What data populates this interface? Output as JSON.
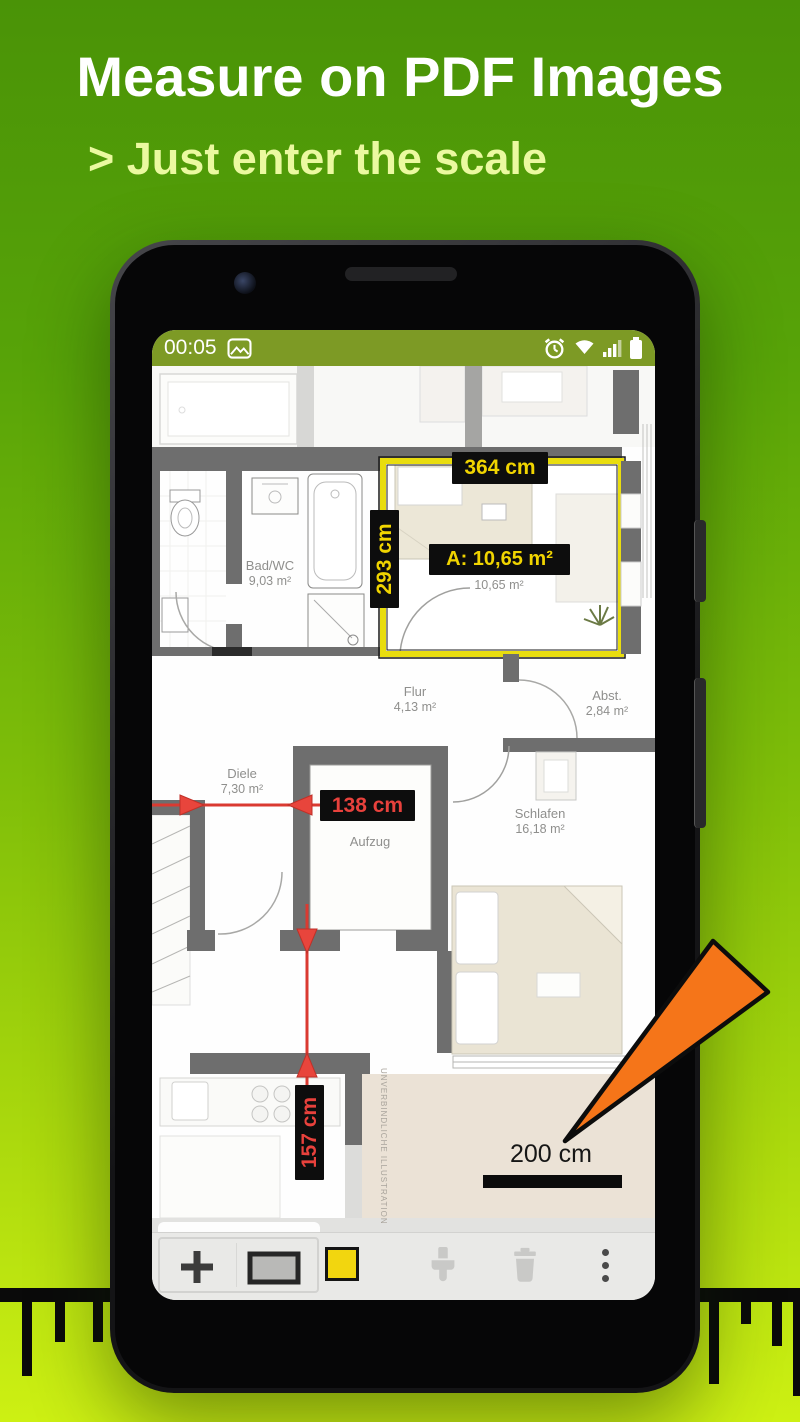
{
  "header": {
    "title": "Measure on PDF Images",
    "subtitle": "> Just enter the scale"
  },
  "statusbar": {
    "time": "00:05"
  },
  "measurements": {
    "width_label": "364 cm",
    "height_label": "293 cm",
    "area_label": "A: 10,65 m²",
    "corridor_label": "138 cm",
    "kitchen_label": "157 cm"
  },
  "floorplan": {
    "rooms": {
      "badwc": {
        "name": "Bad/WC",
        "area": "9,03 m²"
      },
      "zimmer": {
        "name": "Zimmer",
        "area": "10,65 m²"
      },
      "flur": {
        "name": "Flur",
        "area": "4,13 m²"
      },
      "abst": {
        "name": "Abst.",
        "area": "2,84 m²"
      },
      "diele": {
        "name": "Diele",
        "area": "7,30 m²"
      },
      "aufzug": {
        "name": "Aufzug"
      },
      "schlafen": {
        "name": "Schlafen",
        "area": "16,18 m²"
      }
    },
    "scale_label": "200 cm",
    "watermark": "UNVERBINDLICHE ILLUSTRATION"
  },
  "colors": {
    "bg_top": "#4a9307",
    "bg_bottom": "#cdf013",
    "status_bar": "#7d9a25",
    "highlight_yellow": "#f0d400",
    "measure_red": "#e8413c",
    "room_outline_yellow": "#e9dd0e",
    "arrow_orange": "#f57519",
    "swatch_yellow": "#f2d60f"
  }
}
